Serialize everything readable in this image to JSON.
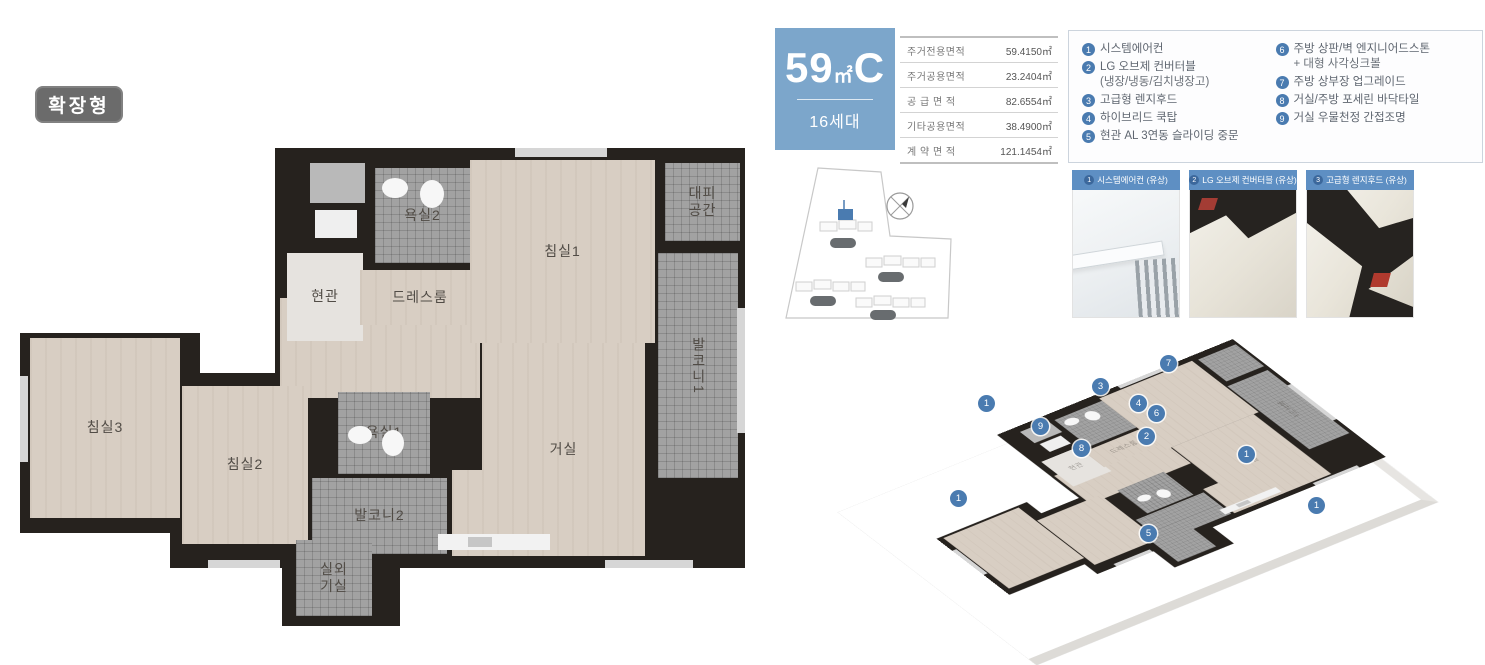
{
  "badge": {
    "label": "확장형"
  },
  "unit_box": {
    "size": "59",
    "unit": "㎡",
    "letter": "C",
    "households": "16세대",
    "bg": "#7ca6cb"
  },
  "area_table": {
    "rows": [
      {
        "label": "주거전용면적",
        "value": "59.4150㎡"
      },
      {
        "label": "주거공용면적",
        "value": "23.2404㎡"
      },
      {
        "label": "공 급 면 적",
        "value": "82.6554㎡"
      },
      {
        "label": "기타공용면적",
        "value": "38.4900㎡"
      },
      {
        "label": "계 약 면 적",
        "value": "121.1454㎡"
      }
    ]
  },
  "features": {
    "left": [
      {
        "num": "1",
        "lines": [
          "시스템에어컨"
        ]
      },
      {
        "num": "2",
        "lines": [
          "LG 오브제 컨버터블",
          "(냉장/냉동/김치냉장고)"
        ]
      },
      {
        "num": "3",
        "lines": [
          "고급형 렌지후드"
        ]
      },
      {
        "num": "4",
        "lines": [
          "하이브리드 쿡탑"
        ]
      },
      {
        "num": "5",
        "lines": [
          "현관 AL 3연동 슬라이딩 중문"
        ]
      }
    ],
    "right": [
      {
        "num": "6",
        "lines": [
          "주방 상판/벽 엔지니어드스톤",
          "+ 대형 사각싱크볼"
        ]
      },
      {
        "num": "7",
        "lines": [
          "주방 상부장 업그레이드"
        ]
      },
      {
        "num": "8",
        "lines": [
          "거실/주방 포세린 바닥타일"
        ]
      },
      {
        "num": "9",
        "lines": [
          "거실 우물천정 간접조명"
        ]
      }
    ]
  },
  "thumbnails": [
    {
      "num": "1",
      "label": "시스템에어컨 (유상)"
    },
    {
      "num": "2",
      "label": "LG 오브제 컨버터블 (유상)"
    },
    {
      "num": "3",
      "label": "고급형 렌지후드 (유상)"
    }
  ],
  "floor_plan": {
    "wall_color": "#26221e",
    "bases": [
      {
        "x": 255,
        "y": 0,
        "w": 470,
        "h": 205
      },
      {
        "x": 255,
        "y": 150,
        "w": 470,
        "h": 270
      },
      {
        "x": 0,
        "y": 185,
        "w": 180,
        "h": 200
      },
      {
        "x": 150,
        "y": 225,
        "w": 170,
        "h": 195
      },
      {
        "x": 262,
        "y": 380,
        "w": 118,
        "h": 98
      }
    ],
    "rooms": [
      {
        "id": "corridor",
        "type": "wood",
        "x": 260,
        "y": 150,
        "w": 200,
        "h": 100
      },
      {
        "id": "entrance",
        "type": "pale",
        "x": 267,
        "y": 105,
        "w": 76,
        "h": 88,
        "lines": [
          "현관"
        ],
        "iso": true
      },
      {
        "id": "bathroom2",
        "type": "tile",
        "x": 355,
        "y": 20,
        "w": 95,
        "h": 95,
        "lines": [
          "욕실2"
        ]
      },
      {
        "id": "dressroom",
        "type": "wood",
        "x": 340,
        "y": 122,
        "w": 120,
        "h": 55,
        "lines": [
          "드레스룸"
        ],
        "iso": true
      },
      {
        "id": "bedroom1",
        "type": "wood",
        "x": 450,
        "y": 12,
        "w": 185,
        "h": 183,
        "lines": [
          "침실1"
        ]
      },
      {
        "id": "refuge",
        "type": "tile",
        "x": 645,
        "y": 15,
        "w": 75,
        "h": 78,
        "lines": [
          "대피",
          "공간"
        ]
      },
      {
        "id": "balcony1",
        "type": "tile",
        "x": 638,
        "y": 105,
        "w": 80,
        "h": 225,
        "lines": [
          "발코니1"
        ],
        "vertical": true,
        "iso": true
      },
      {
        "id": "bedroom3",
        "type": "wood",
        "x": 10,
        "y": 190,
        "w": 150,
        "h": 180,
        "lines": [
          "침실3"
        ]
      },
      {
        "id": "bedroom2",
        "type": "wood",
        "x": 162,
        "y": 238,
        "w": 126,
        "h": 158,
        "lines": [
          "침실2"
        ]
      },
      {
        "id": "bathroom1",
        "type": "tile",
        "x": 318,
        "y": 244,
        "w": 92,
        "h": 82,
        "lines": [
          "욕실1"
        ]
      },
      {
        "id": "balcony2",
        "type": "tile",
        "x": 292,
        "y": 330,
        "w": 135,
        "h": 76,
        "lines": [
          "발코니2"
        ]
      },
      {
        "id": "ac-room",
        "type": "tile",
        "x": 276,
        "y": 392,
        "w": 76,
        "h": 76,
        "lines": [
          "실외",
          "기실"
        ]
      },
      {
        "id": "kitchen",
        "type": "wood",
        "x": 432,
        "y": 322,
        "w": 100,
        "h": 86,
        "lines": [
          "주방"
        ]
      },
      {
        "id": "living",
        "type": "wood",
        "x": 462,
        "y": 195,
        "w": 163,
        "h": 213,
        "lines": [
          "거실"
        ],
        "iso": true
      }
    ],
    "fixtures": [
      {
        "x": 290,
        "y": 15,
        "w": 55,
        "h": 40,
        "fill": "#b9b9b9"
      },
      {
        "x": 295,
        "y": 62,
        "w": 42,
        "h": 28,
        "fill": "#efefef"
      },
      {
        "x": 362,
        "y": 30,
        "w": 26,
        "h": 20,
        "fill": "#f7f7f7",
        "round": true
      },
      {
        "x": 400,
        "y": 32,
        "w": 24,
        "h": 28,
        "fill": "#f7f7f7",
        "round": true
      },
      {
        "x": 328,
        "y": 278,
        "w": 24,
        "h": 18,
        "fill": "#f7f7f7",
        "round": true
      },
      {
        "x": 362,
        "y": 282,
        "w": 22,
        "h": 26,
        "fill": "#f7f7f7",
        "round": true
      },
      {
        "x": 418,
        "y": 386,
        "w": 112,
        "h": 16,
        "fill": "#f2f2f2"
      },
      {
        "x": 448,
        "y": 389,
        "w": 24,
        "h": 10,
        "fill": "#c6c6c6"
      },
      {
        "x": 495,
        "y": 0,
        "w": 92,
        "h": 9,
        "fill": "#d6d6d6"
      },
      {
        "x": 0,
        "y": 228,
        "w": 8,
        "h": 86,
        "fill": "#d6d6d6"
      },
      {
        "x": 188,
        "y": 412,
        "w": 72,
        "h": 8,
        "fill": "#d6d6d6"
      },
      {
        "x": 585,
        "y": 412,
        "w": 88,
        "h": 8,
        "fill": "#d6d6d6"
      },
      {
        "x": 717,
        "y": 160,
        "w": 8,
        "h": 125,
        "fill": "#d6d6d6"
      }
    ]
  },
  "iso_badges": [
    {
      "n": "1",
      "x": 133,
      "y": 95
    },
    {
      "n": "9",
      "x": 187,
      "y": 118
    },
    {
      "n": "3",
      "x": 247,
      "y": 78
    },
    {
      "n": "7",
      "x": 315,
      "y": 55
    },
    {
      "n": "4",
      "x": 285,
      "y": 95
    },
    {
      "n": "6",
      "x": 303,
      "y": 105
    },
    {
      "n": "2",
      "x": 293,
      "y": 128
    },
    {
      "n": "8",
      "x": 228,
      "y": 140
    },
    {
      "n": "1",
      "x": 105,
      "y": 190
    },
    {
      "n": "5",
      "x": 295,
      "y": 225
    },
    {
      "n": "1",
      "x": 393,
      "y": 146
    },
    {
      "n": "1",
      "x": 463,
      "y": 197
    }
  ],
  "colors": {
    "accent_blue": "#7ca6cb",
    "badge_blue": "#4a7bb0",
    "thumb_header_blue": "#5e8fc3",
    "wall": "#26221e",
    "wood_floor": "#d8cec3",
    "tile": "#a2a2a2",
    "badge_gray": "#6b6b6b"
  }
}
